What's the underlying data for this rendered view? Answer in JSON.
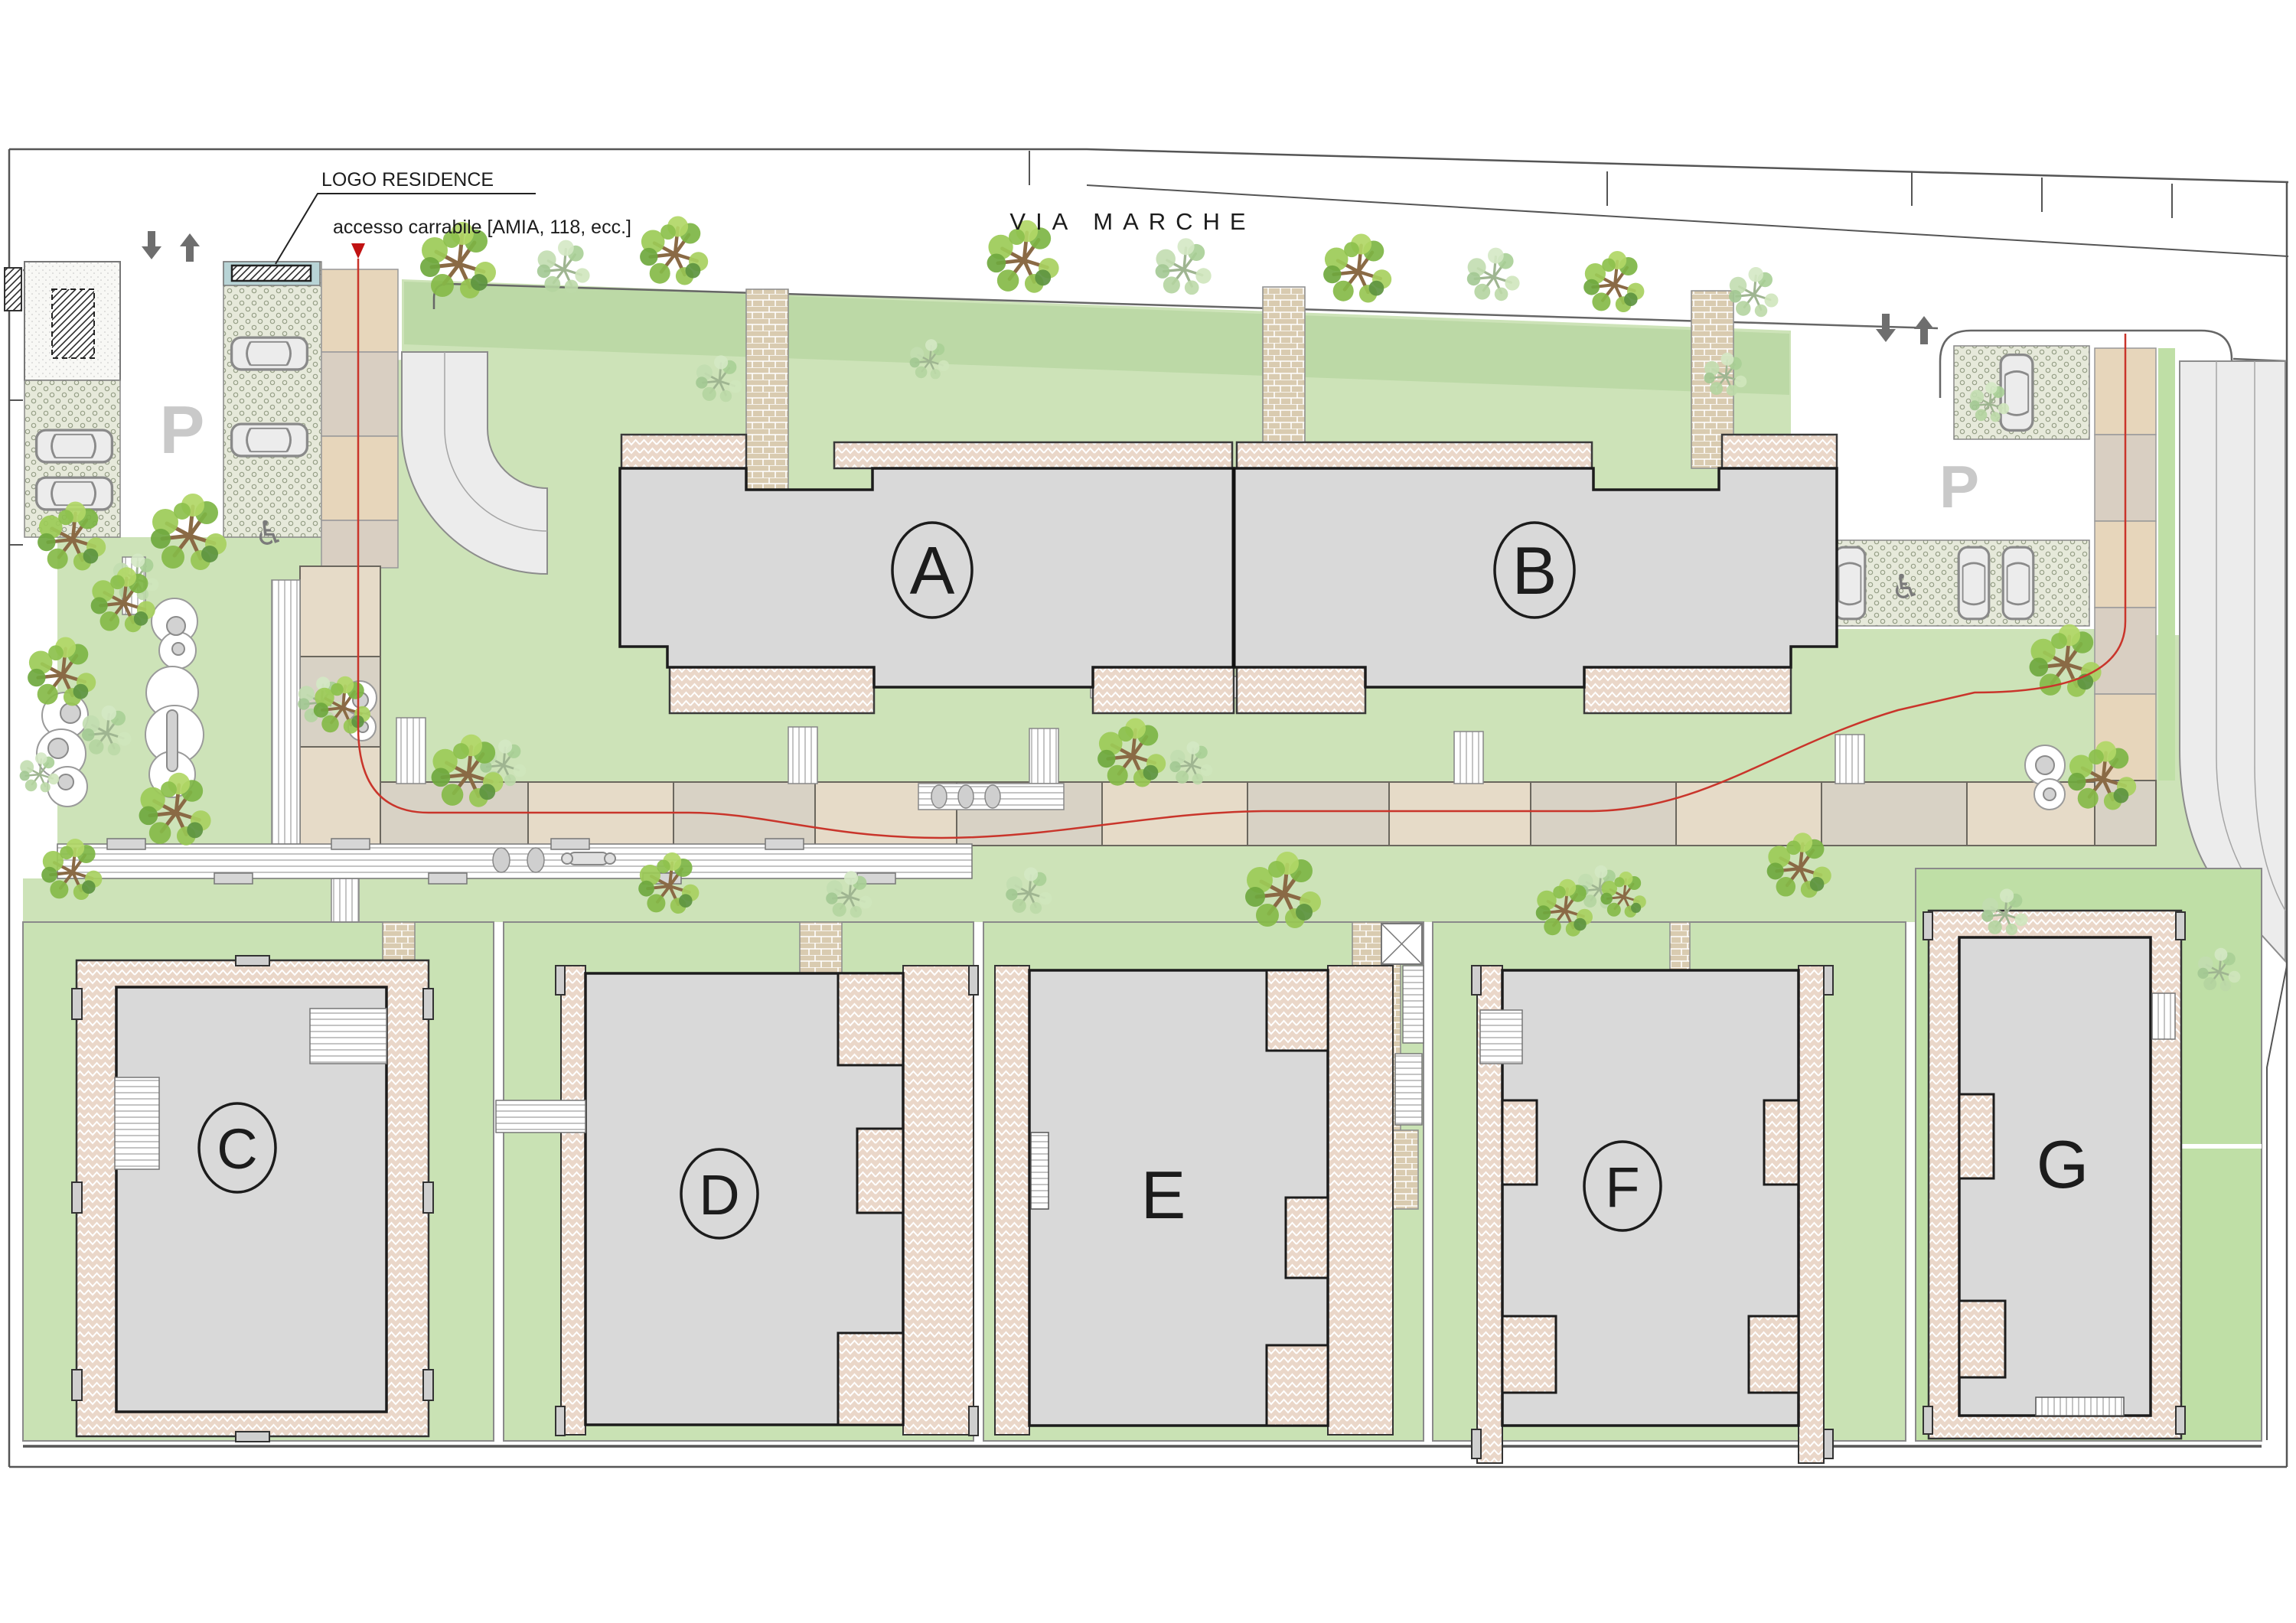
{
  "drawing": {
    "street_name": "VIA MARCHE",
    "annotations": {
      "logo_label": "LOGO RESIDENCE",
      "access_label": "accesso carrabile [AMIA, 118, ecc.]"
    },
    "buildings": [
      {
        "id": "A",
        "circled": true
      },
      {
        "id": "B",
        "circled": true
      },
      {
        "id": "C",
        "circled": true
      },
      {
        "id": "D",
        "circled": true
      },
      {
        "id": "E",
        "circled": false
      },
      {
        "id": "F",
        "circled": true
      },
      {
        "id": "G",
        "circled": false
      }
    ],
    "parking_labels": {
      "left": "P",
      "right": "P"
    },
    "icons": {
      "accessible": "♿"
    },
    "colors": {
      "lawn": "#cde3b8",
      "lawn_bright": "#bfdfa6",
      "building_fill": "#d9d9d9",
      "paving_pink": "#ead7c9",
      "brick": "#d9cbb0",
      "slab_beige": "#e6dbc8",
      "slab_taupe": "#d8d2c5",
      "route_red": "#c9352b",
      "sign_teal": "#b8d4d6"
    }
  }
}
